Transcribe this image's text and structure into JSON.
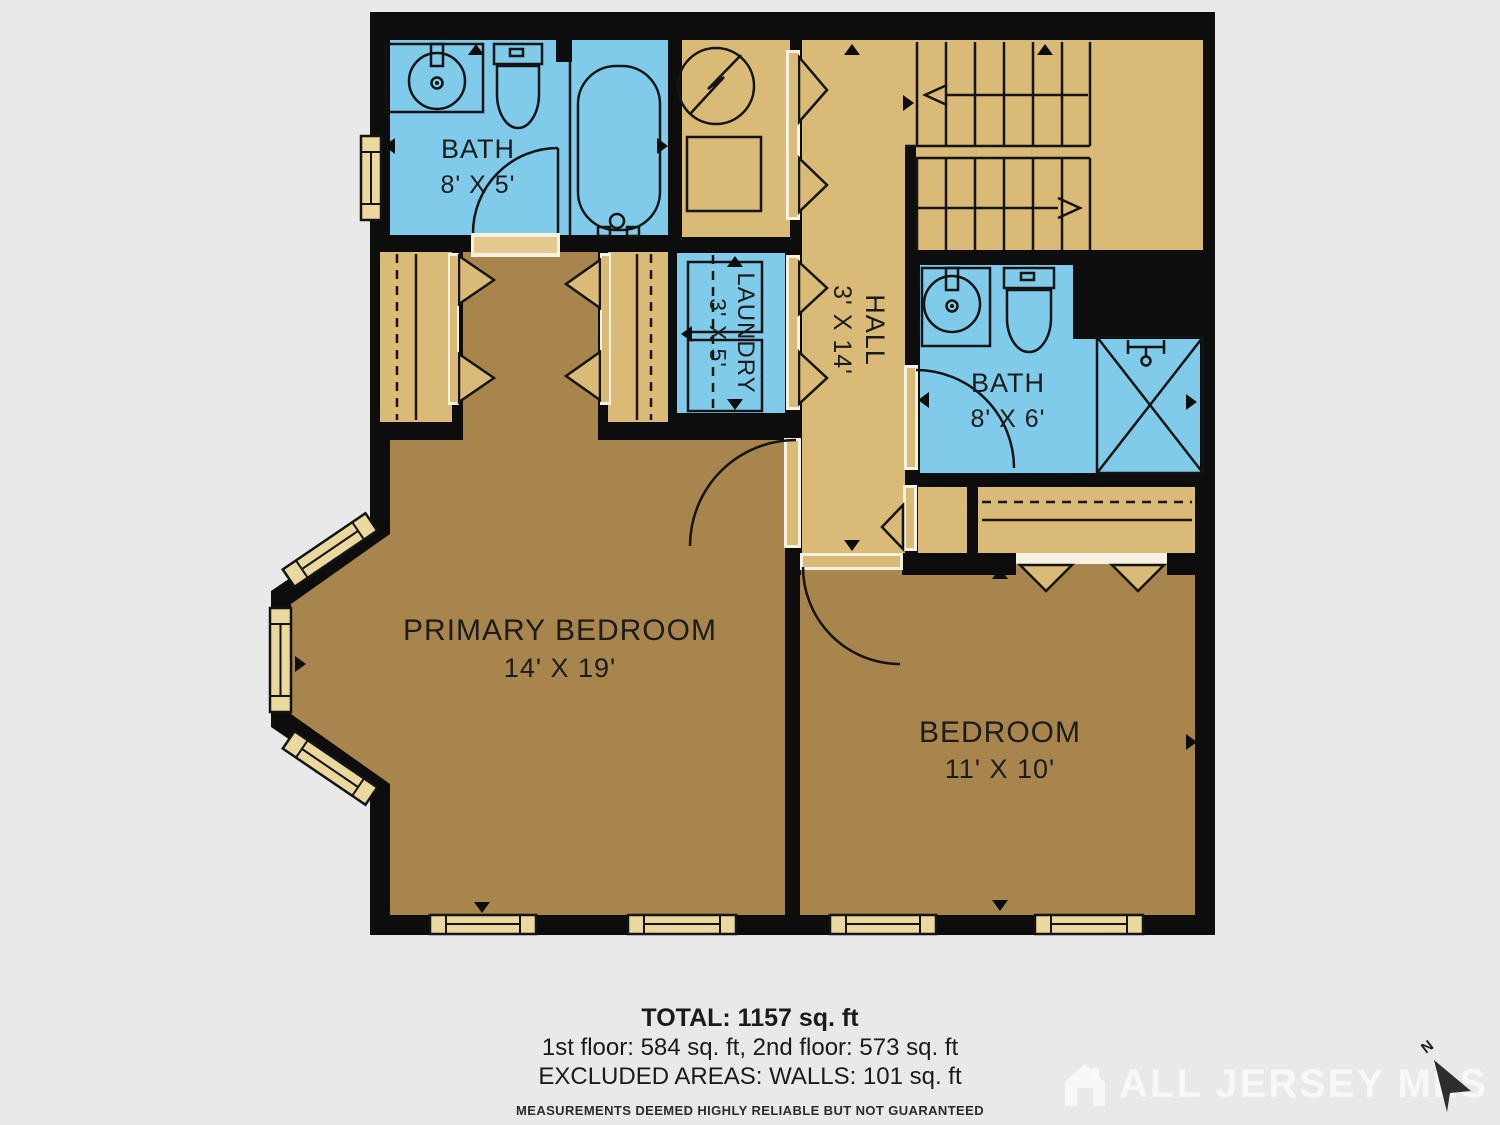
{
  "rooms": {
    "bath1": {
      "label": "BATH",
      "dims": "8' X 5'"
    },
    "laundry": {
      "label": "LAUNDRY",
      "dims": "3' X 5'"
    },
    "hall": {
      "label": "HALL",
      "dims": "3' X 14'"
    },
    "bath2": {
      "label": "BATH",
      "dims": "8' X 6'"
    },
    "primary_bedroom": {
      "label": "PRIMARY BEDROOM",
      "dims": "14' X 19'"
    },
    "bedroom": {
      "label": "BEDROOM",
      "dims": "11' X 10'"
    }
  },
  "summary": {
    "total": "TOTAL: 1157 sq. ft",
    "floors": "1st floor: 584 sq. ft, 2nd floor: 573 sq. ft",
    "excluded": "EXCLUDED AREAS: WALLS: 101 sq. ft",
    "disclaimer": "MEASUREMENTS DEEMED HIGHLY RELIABLE BUT NOT GUARANTEED"
  },
  "watermark": {
    "text": "ALL JERSEY MLS"
  },
  "compass": {
    "label": "N"
  },
  "icons": {
    "fixtures": [
      "sink-icon",
      "toilet-icon",
      "bathtub-icon",
      "shower-icon",
      "washer-dryer-icon",
      "water-heater-icon",
      "furnace-icon",
      "stairs",
      "bifold-door",
      "swing-door",
      "window",
      "north-arrow-icon",
      "house-logo-icon"
    ]
  },
  "colors": {
    "wall": "#0d0d0d",
    "floor_light": "#d9ba77",
    "floor_dark": "#a8854d",
    "wet_room": "#7fcbe9",
    "window_fill": "#ead89f",
    "door_gap": "#f7f1e1",
    "background": "#e9e9e9"
  }
}
